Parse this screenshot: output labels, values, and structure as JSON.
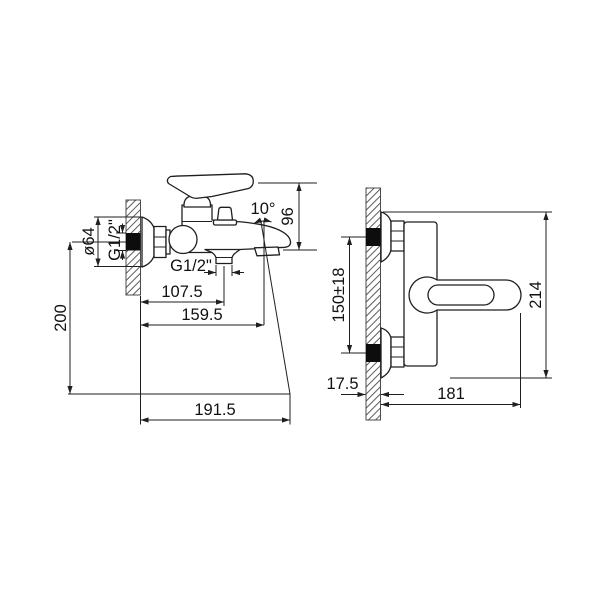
{
  "drawing": {
    "type": "technical-dimension-drawing",
    "subject": "wall-mounted bath mixer faucet, two views",
    "colors": {
      "background": "#ffffff",
      "line": "#1f1f1f",
      "text": "#111111",
      "connection_fill": "#0d0d0d"
    },
    "side_view": {
      "dim_height": "200",
      "dim_escutcheon_diameter": "ø64",
      "dim_inlet_thread": "G1/2\"",
      "dim_outlet_thread": "G1/2\"",
      "dim_wall_to_shower_outlet": "107.5",
      "dim_wall_to_outlet_axis": "159.5",
      "dim_wall_to_spout_tip": "191.5",
      "dim_spout_angle": "10°",
      "dim_top_to_spout_outlet": "96"
    },
    "front_view": {
      "dim_connection_spacing": "150±18",
      "dim_wall_thickness": "17.5",
      "dim_wall_to_handle_end": "181",
      "dim_overall_length": "214"
    }
  }
}
